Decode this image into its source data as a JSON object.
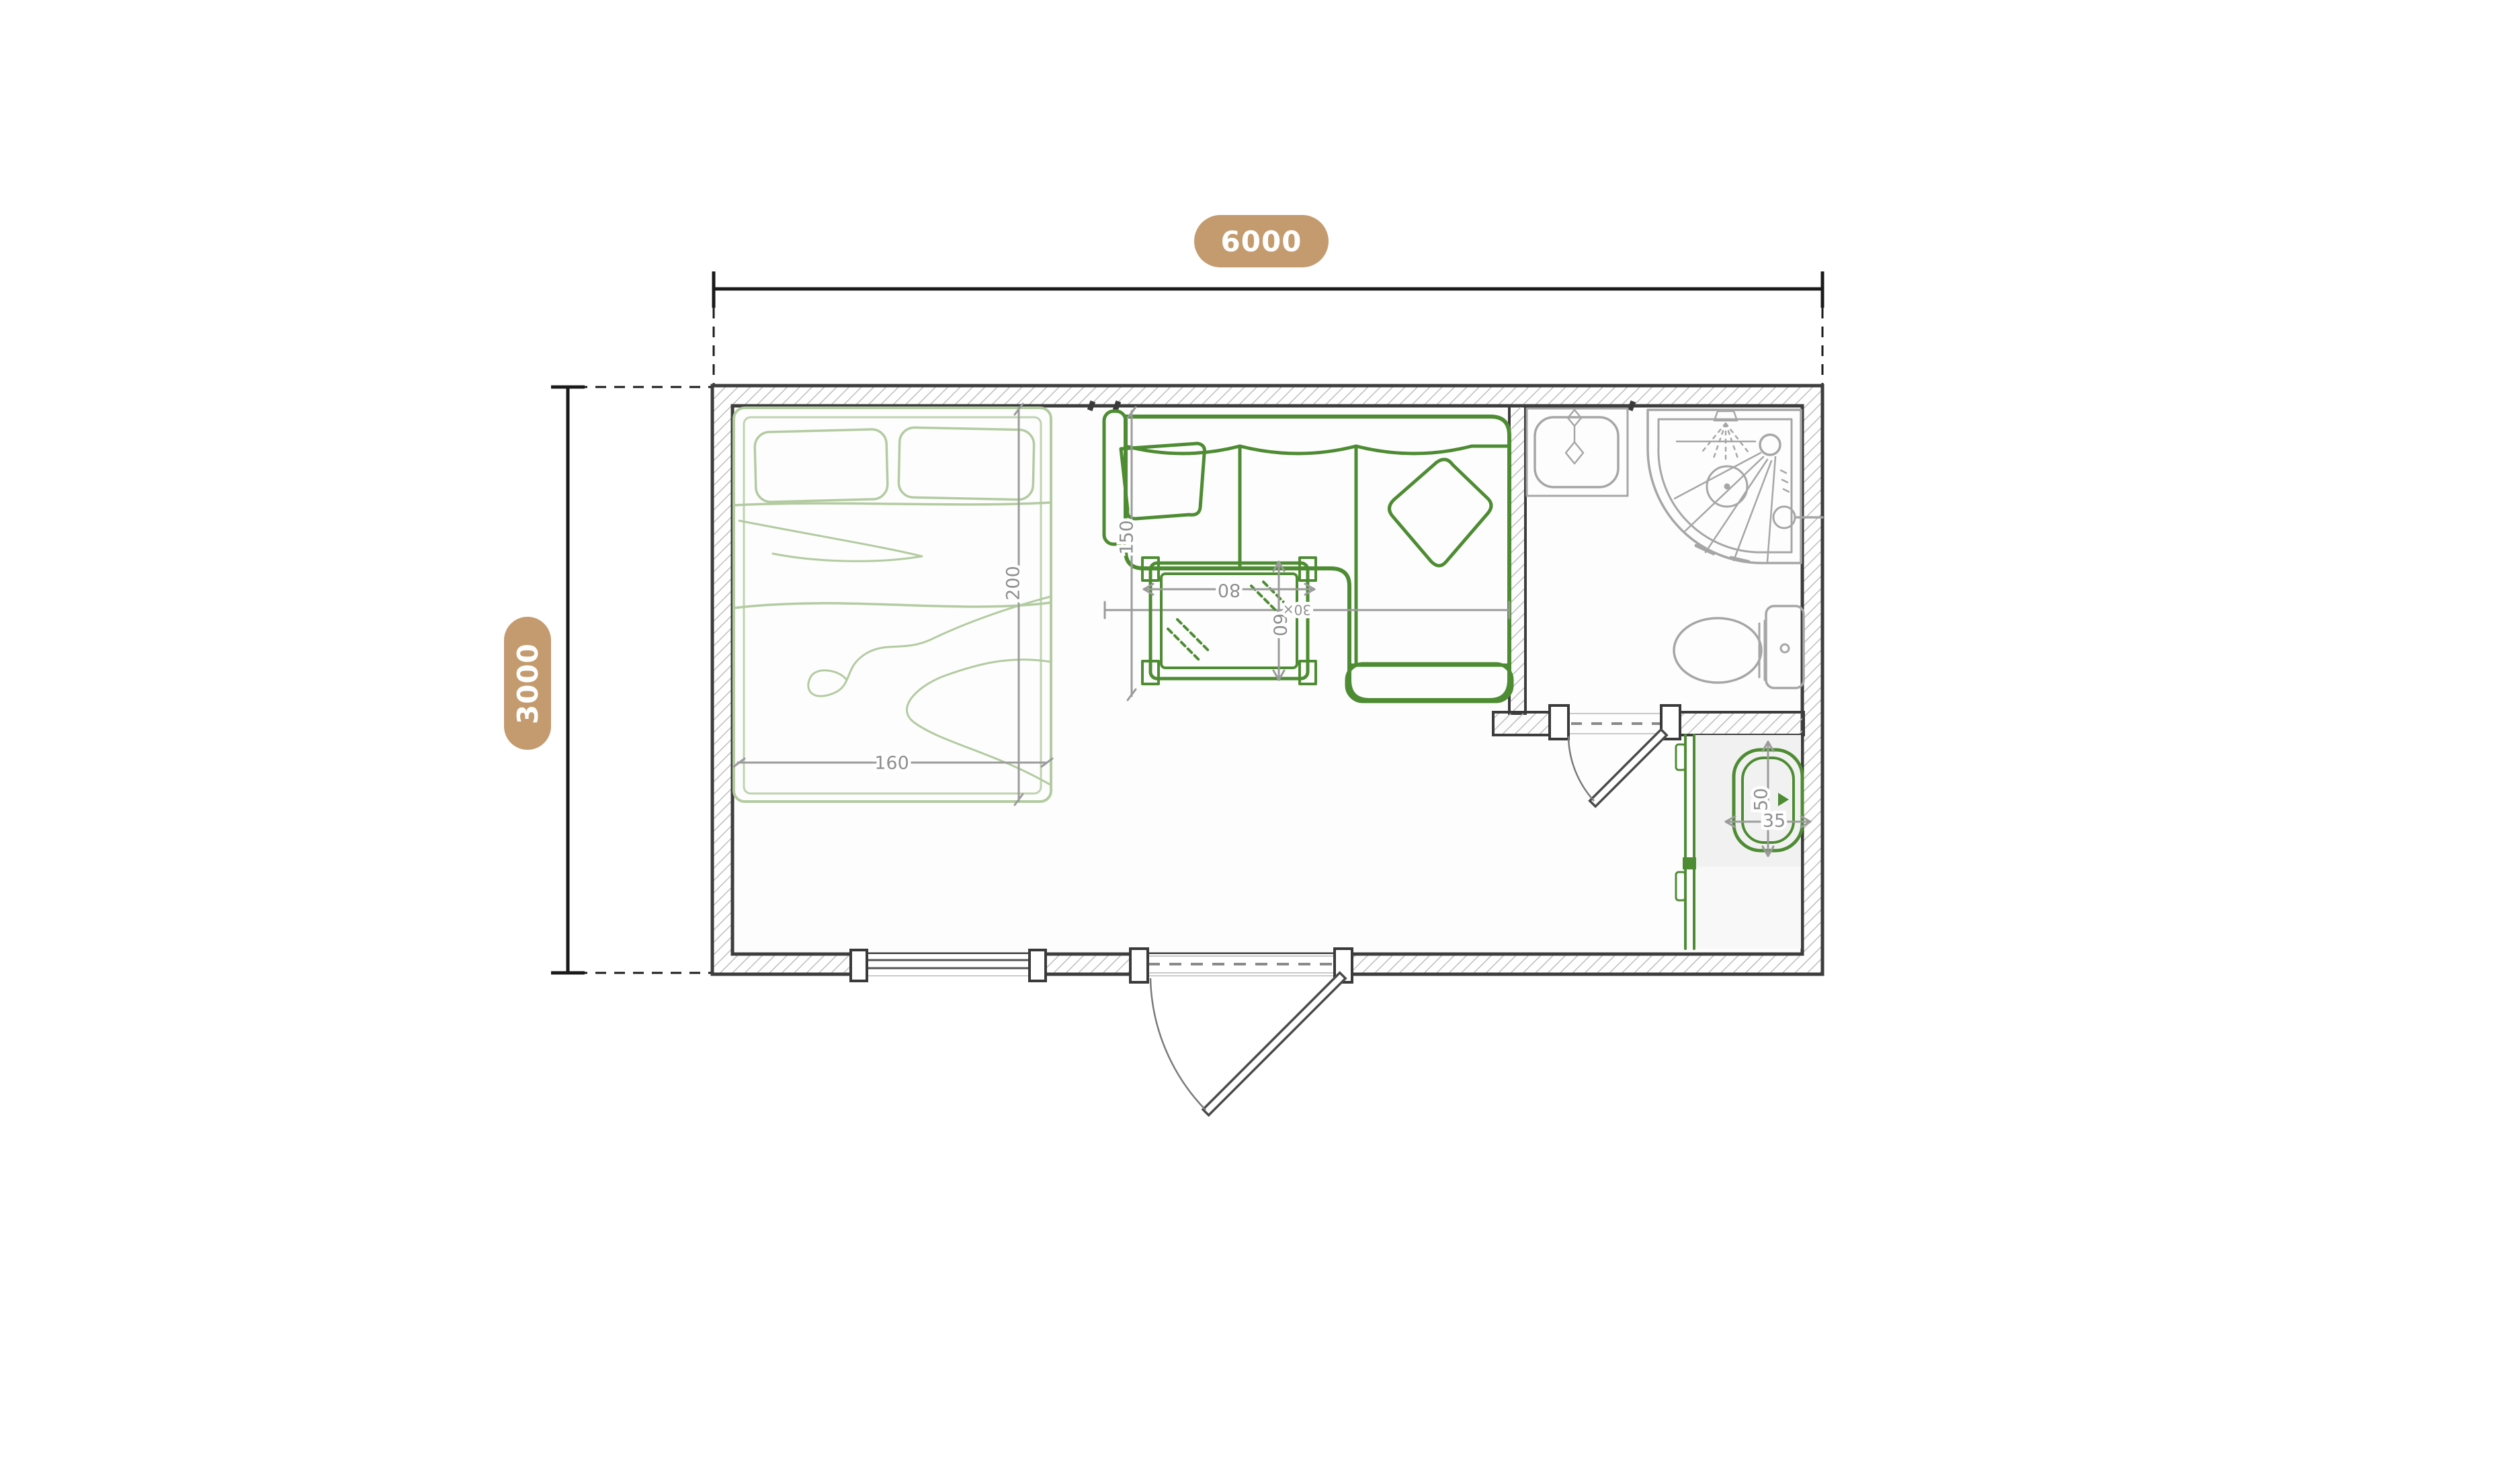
{
  "overall_dimensions": {
    "width_label": "6000",
    "height_label": "3000"
  },
  "annotations": {
    "bed_width": "160",
    "bed_length": "200",
    "sofa_length": "150",
    "table_width": "80",
    "table_depth": "60",
    "table_note": "30×",
    "basin_length": "50",
    "basin_width": "35"
  },
  "colors": {
    "badge_bg": "#C49B6E",
    "badge_text": "#FFFFFF",
    "wall_line": "#3D3D3D",
    "hatch_line": "#BDBDBD",
    "furniture_green": "#4E8C33",
    "furniture_light_green": "#B3CBA1",
    "fixture_gray": "#A6A6A6",
    "dim_gray": "#9B9B9B",
    "dim_text": "#8F8F8F",
    "floor_shade": "#F1F1F1",
    "dim_black": "#1A1A1A",
    "page_bg": "#FFFFFF"
  }
}
